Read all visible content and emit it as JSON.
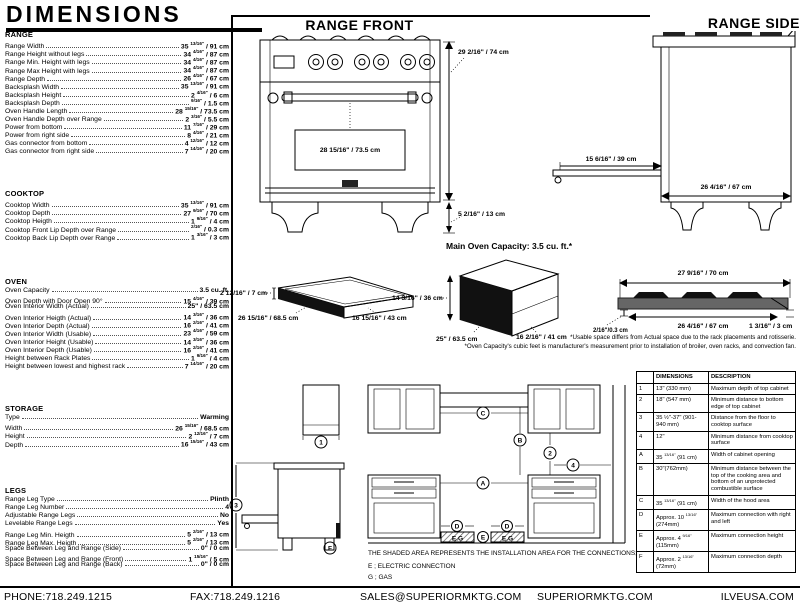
{
  "page_title": "DIMENSIONS",
  "spec_sections": [
    {
      "title": "RANGE",
      "rows": [
        {
          "label": "Range Width",
          "value": "35 13/16\" / 91 cm"
        },
        {
          "label": "Range Height without legs",
          "value": "34 4/16\" / 87 cm"
        },
        {
          "label": "Range Min. Height with legs",
          "value": "34 4/16\" / 87 cm"
        },
        {
          "label": "Range Max Height with legs",
          "value": "34 4/16\" / 87 cm"
        },
        {
          "label": "Range Depth",
          "value": "26 4/16\" / 67 cm"
        },
        {
          "label": "Backsplash Width",
          "value": "35 13/16\" / 91 cm"
        },
        {
          "label": "Backsplash Height",
          "value": "2 4/16\" / 6 cm"
        },
        {
          "label": "Backsplash Depth",
          "value": "9/16\" / 1.5 cm"
        },
        {
          "label": "Oven Handle Length",
          "value": "28 15/16\" / 73.5 cm"
        },
        {
          "label": "Oven Handle Depth over Range",
          "value": "2 3/16\" / 5.5 cm"
        },
        {
          "label": "Power from bottom",
          "value": "11 7/16\" / 29 cm"
        },
        {
          "label": "Power from right side",
          "value": "8 4/16\" / 21 cm"
        },
        {
          "label": "Gas connector from bottom",
          "value": "4 12/16\" / 12 cm"
        },
        {
          "label": "Gas connector from right side",
          "value": "7 14/16\" / 20 cm"
        }
      ]
    },
    {
      "title": "COOKTOP",
      "rows": [
        {
          "label": "Cooktop Width",
          "value": "35 13/16\" / 91 cm"
        },
        {
          "label": "Cooktop Depth",
          "value": "27 9/16\" / 70 cm"
        },
        {
          "label": "Cooktop Heigth",
          "value": "1 9/16\" / 4 cm"
        },
        {
          "label": "Cooktop Front Lip Depth over Range",
          "value": "2/16\" / 0.3 cm"
        },
        {
          "label": "Cooktop Back Lip Depth over Range",
          "value": "1 3/16\" / 3 cm"
        }
      ]
    },
    {
      "title": "OVEN",
      "rows": [
        {
          "label": "Oven Capacity",
          "value": "3.5 cu. ft."
        },
        {
          "label": "Oven Depth with Door Open 90°",
          "value": "15 4/16\" / 39 cm"
        },
        {
          "label": "Oven Interior Width (Actual)",
          "value": "25\" / 63.5 cm"
        },
        {
          "label": "Oven Interior Heigth (Actual)",
          "value": "14 3/16\" / 36 cm"
        },
        {
          "label": "Oven Interior Depth (Actual)",
          "value": "16 2/16\" / 41 cm"
        },
        {
          "label": "Oven Interior Width (Usable)",
          "value": "23 4/16\" / 59 cm"
        },
        {
          "label": "Oven Interior Height (Usable)",
          "value": "14 3/16\" / 36 cm"
        },
        {
          "label": "Oven Interior Depth (Usable)",
          "value": "16 2/16\" / 41 cm"
        },
        {
          "label": "Height between Rack Plates",
          "value": "1 9/16\" / 4 cm"
        },
        {
          "label": "Height between lowest and highest rack",
          "value": "7 14/16\" / 20 cm"
        }
      ]
    },
    {
      "title": "STORAGE",
      "rows": [
        {
          "label": "Type",
          "value": "Warming"
        },
        {
          "label": "Width",
          "value": "26 15/16\" / 68.5 cm"
        },
        {
          "label": "Height",
          "value": "2 12/16\" / 7 cm"
        },
        {
          "label": "Depth",
          "value": "16 15/16\" / 43 cm"
        }
      ]
    },
    {
      "title": "LEGS",
      "rows": [
        {
          "label": "Range Leg Type",
          "value": "Plinth"
        },
        {
          "label": "Range Leg Number",
          "value": "4"
        },
        {
          "label": "Adjustable Range Legs",
          "value": "No"
        },
        {
          "label": "Levelable Range Legs",
          "value": "Yes"
        },
        {
          "label": "Range Leg Min. Heigth",
          "value": "5 2/16\" / 13 cm"
        },
        {
          "label": "Range Leg Max. Heigth",
          "value": "5 2/16\" / 13 cm"
        },
        {
          "label": "Space Between Leg and Range (Side)",
          "value": "0\" / 0 cm"
        },
        {
          "label": "Space Between Leg and Range (Front)",
          "value": "1 15/16\" / 5 cm"
        },
        {
          "label": "Space Between Leg and Range (Back)",
          "value": "0\" / 0 cm"
        }
      ]
    }
  ],
  "diagrams": {
    "range_front": {
      "title": "RANGE FRONT",
      "handle_dim": "28 15/16\" / 73.5 cm",
      "height_dim": "29 2/16\" / 74 cm",
      "leg_dim": "5 2/16\" / 13 cm"
    },
    "range_side": {
      "title": "RANGE SIDE",
      "door_dim": "15 6/16\" / 39 cm",
      "depth_dim": "26 4/16\" / 67 cm"
    },
    "main_oven_capacity": "Main Oven Capacity: 3.5 cu. ft.*",
    "storage_drawer": {
      "height_dim": "2 12/16\" / 7 cm",
      "width_dim": "26 15/16\" / 68.5 cm",
      "depth_dim": "16 15/16\" / 43 cm"
    },
    "oven_interior": {
      "height_dim": "14 3/16\" / 36 cm",
      "width_dim": "25\" / 63.5 cm",
      "depth_dim": "16 2/16\" / 41 cm"
    },
    "cooktop_profile": {
      "top_dim": "27 9/16\" / 70 cm",
      "inner_dim": "26 4/16\" / 67 cm",
      "front_lip_dim": "2/16\"/0.3 cm",
      "back_lip_dim": "1 3/16\" / 3 cm"
    },
    "installation": {
      "callouts": {
        "n1": "1",
        "n2": "2",
        "n3": "3",
        "n4": "4",
        "A": "A",
        "B": "B",
        "C": "C",
        "D": "D",
        "E": "E",
        "F": "F"
      },
      "connection_box_label": "E.G"
    }
  },
  "footnotes": [
    "*Usable space differs from Actual space due to the rack placements and rotisserie.",
    "*Oven Capacity's cubic feet is manufacturer's measurement prior to installation of broiler, oven racks, and convection fan."
  ],
  "installation_notes": {
    "shaded": "THE SHADED AREA REPRESENTS THE INSTALLATION AREA FOR THE CONNECTIONS;",
    "electric": "E ; ELECTRIC CONNECTION",
    "gas": "G ; GAS"
  },
  "table": {
    "headers": [
      "",
      "DIMENSIONS",
      "DESCRIPTION"
    ],
    "rows": [
      {
        "id": "1",
        "dimension": "13\" (330 mm)",
        "description": "Maximum depth of top cabinet"
      },
      {
        "id": "2",
        "dimension": "18\" (547 mm)",
        "description": "Minimum distance to bottom edge of top cabinet"
      },
      {
        "id": "3",
        "dimension": "35 ½\"-37\" (901-940 mm)",
        "description": "Distance from the floor to cooktop surface"
      },
      {
        "id": "4",
        "dimension": "12\"",
        "description": "Minimum distance from cooktop surface"
      },
      {
        "id": "A",
        "dimension": "35 13/16\" (91 cm)",
        "description": "Width of cabinet opening"
      },
      {
        "id": "B",
        "dimension": "30\"(762mm)",
        "description": "Minimum distance between the top of the cooking area and bottom of an unprotected combustible surface"
      },
      {
        "id": "C",
        "dimension": "35 13/16\" (91 cm)",
        "description": "Width of the hood area"
      },
      {
        "id": "D",
        "dimension": "Approx. 10 13/16\" (274mm)",
        "description": "Maximum connection with right and left"
      },
      {
        "id": "E",
        "dimension": "Approx. 4 9/16\" (115mm)",
        "description": "Maximum connection height"
      },
      {
        "id": "F",
        "dimension": "Approx. 2 13/16\" (72mm)",
        "description": "Maximum connection depth"
      }
    ]
  },
  "footer": {
    "phone": "PHONE:718.249.1215",
    "fax": "FAX:718.249.1216",
    "email": "SALES@SUPERIORMKTG.COM",
    "site": "SUPERIORMKTG.COM",
    "brand_site": "ILVEUSA.COM"
  }
}
